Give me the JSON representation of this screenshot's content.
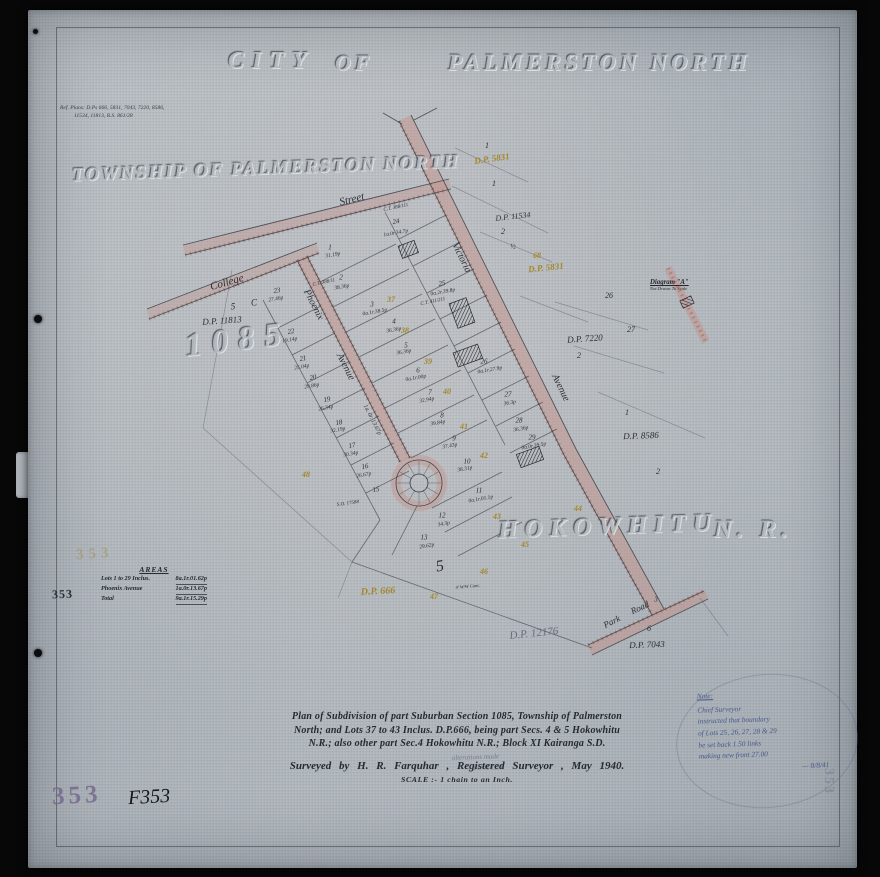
{
  "titles": {
    "city": "CITY",
    "of": "OF",
    "palmerston": "PALMERSTON NORTH",
    "township": "TOWNSHIP OF PALMERSTON NORTH",
    "section_number": "1085",
    "hokowhitu": "HOKOWHITU",
    "nr": "N. R."
  },
  "ref_note": {
    "line1": "Ref. Plans: D.Ps 666, 5831, 7043, 7220, 8586,",
    "line2": "11534, 11813,  R.S. 861/28"
  },
  "areas_table": {
    "title": "AREAS",
    "rows": [
      {
        "label": "Lots 1 to 29 Inclus.",
        "value": "8a.1r.01.62p"
      },
      {
        "label": "Phoenix Avenue",
        "value": "1a.0r.13.67p"
      },
      {
        "label": "Total",
        "value": "9a.1r.15.29p"
      }
    ]
  },
  "title_block": {
    "line1": "Plan of Subdivision of part Suburban Section 1085, Township of Palmerston",
    "line2": "North; and Lots 37 to 43 Inclus. D.P.666, being part Secs. 4 & 5 Hokowhitu",
    "line3": "N.R.; also other part Sec.4 Hokowhitu N.R.; Block XI Kairanga S.D.",
    "surveyed": "Surveyed by    H. R. Farquhar , Registered Surveyor ,   May 1940.",
    "scale": "SCALE :-  1 chain to an Inch."
  },
  "note": {
    "heading": "Note:",
    "lines": [
      "Chief Surveyor",
      "instructed that boundary",
      "of Lots 25, 26, 27, 28 & 29",
      "be set back 1.50 links",
      "making new front 27.00"
    ],
    "signoff": "— 8/8/41"
  },
  "pencil_note": {
    "line1": "alterations made",
    "line2": "18/1/41    L.M."
  },
  "stamps": {
    "faint_gold": "353",
    "margin": "353",
    "purple": "353",
    "ink": "F353",
    "edge": "353"
  },
  "diagram_a": {
    "title": "Diagram \"A\"",
    "subtitle": "Not Drawn To Scale"
  },
  "map_labels": [
    {
      "t": "Street",
      "x": 352,
      "y": 200,
      "r": -14,
      "s": 11
    },
    {
      "t": "College",
      "x": 227,
      "y": 283,
      "r": -16,
      "s": 11
    },
    {
      "t": "Phoenix",
      "x": 313,
      "y": 305,
      "r": 63,
      "s": 10
    },
    {
      "t": "Avenue",
      "x": 345,
      "y": 367,
      "r": 63,
      "s": 10
    },
    {
      "t": "1a. 0r. 13.67p",
      "x": 372,
      "y": 420,
      "r": 63,
      "s": 6
    },
    {
      "t": "Victoria",
      "x": 461,
      "y": 258,
      "r": 64,
      "s": 10
    },
    {
      "t": "Avenue",
      "x": 560,
      "y": 388,
      "r": 64,
      "s": 10
    },
    {
      "t": "Park",
      "x": 612,
      "y": 622,
      "r": -26,
      "s": 9
    },
    {
      "t": "Road",
      "x": 640,
      "y": 608,
      "r": -26,
      "s": 9
    },
    {
      "t": "3",
      "x": 656,
      "y": 600,
      "r": 0,
      "s": 7
    },
    {
      "t": "D.P. 5831",
      "x": 492,
      "y": 159,
      "r": -8,
      "s": 9,
      "c": "yel"
    },
    {
      "t": "1",
      "x": 487,
      "y": 146,
      "r": 0,
      "s": 8
    },
    {
      "t": "1",
      "x": 494,
      "y": 184,
      "r": 0,
      "s": 8
    },
    {
      "t": "D.P. 11534",
      "x": 513,
      "y": 217,
      "r": -6,
      "s": 8
    },
    {
      "t": "2",
      "x": 503,
      "y": 232,
      "r": 0,
      "s": 8
    },
    {
      "t": "½",
      "x": 513,
      "y": 247,
      "r": 0,
      "s": 7
    },
    {
      "t": "68",
      "x": 537,
      "y": 256,
      "r": 0,
      "s": 8,
      "c": "yel"
    },
    {
      "t": "D.P. 5831",
      "x": 546,
      "y": 268,
      "r": -6,
      "s": 9,
      "c": "yel"
    },
    {
      "t": "5",
      "x": 233,
      "y": 307,
      "r": 0,
      "s": 9
    },
    {
      "t": "C",
      "x": 254,
      "y": 303,
      "r": 0,
      "s": 9
    },
    {
      "t": "D.P. 11813",
      "x": 222,
      "y": 321,
      "r": -4,
      "s": 9
    },
    {
      "t": "D.P. 7220",
      "x": 585,
      "y": 339,
      "r": -4,
      "s": 9
    },
    {
      "t": "2",
      "x": 579,
      "y": 356,
      "r": 0,
      "s": 8
    },
    {
      "t": "1",
      "x": 627,
      "y": 413,
      "r": 0,
      "s": 8
    },
    {
      "t": "D.P. 8586",
      "x": 641,
      "y": 436,
      "r": -2,
      "s": 9
    },
    {
      "t": "2",
      "x": 658,
      "y": 472,
      "r": 0,
      "s": 8
    },
    {
      "t": "D.P. 666",
      "x": 378,
      "y": 592,
      "r": -3,
      "s": 10,
      "c": "yel"
    },
    {
      "t": "D.P. 12176",
      "x": 534,
      "y": 634,
      "r": -6,
      "s": 11,
      "c": "pen"
    },
    {
      "t": "6",
      "x": 649,
      "y": 629,
      "r": 0,
      "s": 8
    },
    {
      "t": "D.P. 7043",
      "x": 647,
      "y": 645,
      "r": -2,
      "s": 9
    },
    {
      "t": "26",
      "x": 609,
      "y": 296,
      "r": 0,
      "s": 8
    },
    {
      "t": "27",
      "x": 631,
      "y": 330,
      "r": 0,
      "s": 8
    },
    {
      "t": "23",
      "x": 277,
      "y": 291,
      "r": -10,
      "s": 7
    },
    {
      "t": "27.46p",
      "x": 276,
      "y": 300,
      "r": -10,
      "s": 5.5
    },
    {
      "t": "22",
      "x": 291,
      "y": 332,
      "r": -10,
      "s": 7
    },
    {
      "t": "19.14p",
      "x": 290,
      "y": 341,
      "r": -10,
      "s": 5.5
    },
    {
      "t": "21",
      "x": 303,
      "y": 359,
      "r": -10,
      "s": 7
    },
    {
      "t": "25.04p",
      "x": 302,
      "y": 368,
      "r": -10,
      "s": 5.5
    },
    {
      "t": "20",
      "x": 313,
      "y": 378,
      "r": -10,
      "s": 7
    },
    {
      "t": "29.86p",
      "x": 312,
      "y": 387,
      "r": -10,
      "s": 5.5
    },
    {
      "t": "19",
      "x": 327,
      "y": 400,
      "r": -10,
      "s": 7
    },
    {
      "t": "26.34p",
      "x": 326,
      "y": 409,
      "r": -10,
      "s": 5.5
    },
    {
      "t": "18",
      "x": 339,
      "y": 423,
      "r": -10,
      "s": 7
    },
    {
      "t": "32.19p",
      "x": 338,
      "y": 431,
      "r": -10,
      "s": 5.5
    },
    {
      "t": "17",
      "x": 352,
      "y": 446,
      "r": -10,
      "s": 7
    },
    {
      "t": "30.34p",
      "x": 351,
      "y": 455,
      "r": -10,
      "s": 5.5
    },
    {
      "t": "16",
      "x": 365,
      "y": 467,
      "r": -10,
      "s": 7
    },
    {
      "t": "26.67p",
      "x": 364,
      "y": 476,
      "r": -10,
      "s": 5.5
    },
    {
      "t": "15",
      "x": 376,
      "y": 490,
      "r": -10,
      "s": 7
    },
    {
      "t": "C.T. 388/111",
      "x": 396,
      "y": 208,
      "r": -12,
      "s": 5
    },
    {
      "t": "24",
      "x": 396,
      "y": 222,
      "r": -10,
      "s": 7
    },
    {
      "t": "1a.0r.34.7p",
      "x": 396,
      "y": 234,
      "r": -10,
      "s": 5.5
    },
    {
      "t": "1",
      "x": 330,
      "y": 248,
      "r": 0,
      "s": 7
    },
    {
      "t": "31.19p",
      "x": 333,
      "y": 256,
      "r": -10,
      "s": 5.5
    },
    {
      "t": "2",
      "x": 341,
      "y": 278,
      "r": 0,
      "s": 7
    },
    {
      "t": "C.T. 388/11",
      "x": 324,
      "y": 283,
      "r": -12,
      "s": 5
    },
    {
      "t": "38.36p",
      "x": 342,
      "y": 288,
      "r": -10,
      "s": 5.5
    },
    {
      "t": "25",
      "x": 442,
      "y": 284,
      "r": -10,
      "s": 7
    },
    {
      "t": "0a.2r.39.8p",
      "x": 443,
      "y": 293,
      "r": -10,
      "s": 5.5
    },
    {
      "t": "C.T. 411/211",
      "x": 433,
      "y": 302,
      "r": -12,
      "s": 5
    },
    {
      "t": "3",
      "x": 372,
      "y": 305,
      "r": 0,
      "s": 7
    },
    {
      "t": "0a.1r.38.5p",
      "x": 375,
      "y": 313,
      "r": -10,
      "s": 5.5
    },
    {
      "t": "4",
      "x": 394,
      "y": 322,
      "r": 0,
      "s": 7
    },
    {
      "t": "36.36p",
      "x": 394,
      "y": 331,
      "r": -10,
      "s": 5.5
    },
    {
      "t": "5",
      "x": 406,
      "y": 346,
      "r": 0,
      "s": 7
    },
    {
      "t": "36.36p",
      "x": 404,
      "y": 353,
      "r": -10,
      "s": 5.5
    },
    {
      "t": "6",
      "x": 418,
      "y": 371,
      "r": 0,
      "s": 7
    },
    {
      "t": "0a.1r.00p",
      "x": 416,
      "y": 379,
      "r": -10,
      "s": 5.5
    },
    {
      "t": "7",
      "x": 430,
      "y": 393,
      "r": 0,
      "s": 7
    },
    {
      "t": "32.94p",
      "x": 427,
      "y": 401,
      "r": -10,
      "s": 5.5
    },
    {
      "t": "8",
      "x": 442,
      "y": 416,
      "r": 0,
      "s": 7
    },
    {
      "t": "39.84p",
      "x": 438,
      "y": 424,
      "r": -10,
      "s": 5.5
    },
    {
      "t": "9",
      "x": 454,
      "y": 439,
      "r": 0,
      "s": 7
    },
    {
      "t": "37.43p",
      "x": 450,
      "y": 447,
      "r": -10,
      "s": 5.5
    },
    {
      "t": "10",
      "x": 467,
      "y": 462,
      "r": 0,
      "s": 7
    },
    {
      "t": "38.31p",
      "x": 465,
      "y": 470,
      "r": -10,
      "s": 5.5
    },
    {
      "t": "11",
      "x": 479,
      "y": 491,
      "r": 0,
      "s": 7
    },
    {
      "t": "0a.1r.01.1p",
      "x": 481,
      "y": 500,
      "r": -10,
      "s": 5.5
    },
    {
      "t": "12",
      "x": 442,
      "y": 516,
      "r": 0,
      "s": 7
    },
    {
      "t": "34.3p",
      "x": 444,
      "y": 525,
      "r": -10,
      "s": 5.5
    },
    {
      "t": "13",
      "x": 424,
      "y": 538,
      "r": 0,
      "s": 7
    },
    {
      "t": "29.62p",
      "x": 427,
      "y": 547,
      "r": -10,
      "s": 5.5
    },
    {
      "t": "26",
      "x": 484,
      "y": 362,
      "r": 0,
      "s": 7
    },
    {
      "t": "0a.1r.27.9p",
      "x": 490,
      "y": 371,
      "r": -10,
      "s": 5.5
    },
    {
      "t": "27",
      "x": 508,
      "y": 395,
      "r": 0,
      "s": 7
    },
    {
      "t": "36.3p",
      "x": 510,
      "y": 404,
      "r": -10,
      "s": 5.5
    },
    {
      "t": "28",
      "x": 519,
      "y": 421,
      "r": 0,
      "s": 7
    },
    {
      "t": "36.36p",
      "x": 521,
      "y": 430,
      "r": -10,
      "s": 5.5
    },
    {
      "t": "29",
      "x": 532,
      "y": 438,
      "r": 0,
      "s": 7
    },
    {
      "t": "0a.0r.39.5p",
      "x": 534,
      "y": 447,
      "r": -10,
      "s": 5.5
    },
    {
      "t": "37",
      "x": 391,
      "y": 300,
      "r": 0,
      "s": 8,
      "c": "yel"
    },
    {
      "t": "38",
      "x": 405,
      "y": 331,
      "r": 0,
      "s": 8,
      "c": "yel"
    },
    {
      "t": "39",
      "x": 428,
      "y": 362,
      "r": 0,
      "s": 8,
      "c": "yel"
    },
    {
      "t": "40",
      "x": 447,
      "y": 392,
      "r": 0,
      "s": 8,
      "c": "yel"
    },
    {
      "t": "41",
      "x": 464,
      "y": 427,
      "r": 0,
      "s": 8,
      "c": "yel"
    },
    {
      "t": "42",
      "x": 484,
      "y": 456,
      "r": 0,
      "s": 8,
      "c": "yel"
    },
    {
      "t": "43",
      "x": 497,
      "y": 517,
      "r": 0,
      "s": 8,
      "c": "yel"
    },
    {
      "t": "44",
      "x": 578,
      "y": 509,
      "r": 0,
      "s": 8,
      "c": "yel"
    },
    {
      "t": "45",
      "x": 525,
      "y": 545,
      "r": 0,
      "s": 8,
      "c": "yel"
    },
    {
      "t": "46",
      "x": 484,
      "y": 572,
      "r": 0,
      "s": 8,
      "c": "yel"
    },
    {
      "t": "47",
      "x": 434,
      "y": 597,
      "r": 0,
      "s": 8,
      "c": "yel"
    },
    {
      "t": "48",
      "x": 306,
      "y": 475,
      "r": 0,
      "s": 8,
      "c": "yel"
    },
    {
      "t": "5",
      "x": 440,
      "y": 567,
      "r": -10,
      "s": 16
    },
    {
      "t": "S.O. 17588",
      "x": 348,
      "y": 504,
      "r": -8,
      "s": 5
    },
    {
      "t": "4' W/W Conc.",
      "x": 468,
      "y": 587,
      "r": -5,
      "s": 4.5
    }
  ]
}
